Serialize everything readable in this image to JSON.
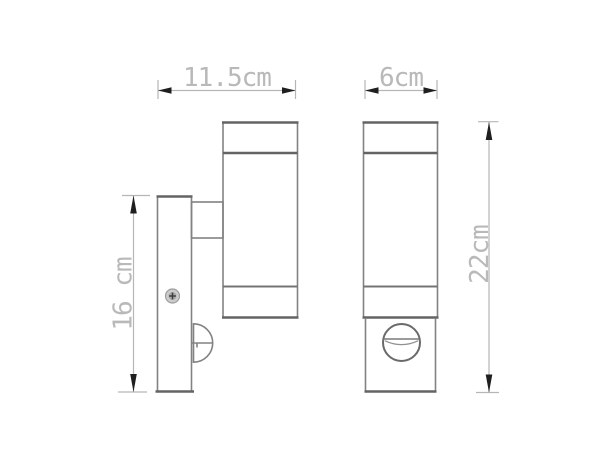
{
  "drawing": {
    "type": "technical-dimension-drawing",
    "unit": "cm",
    "dimensions": [
      {
        "id": "overall-depth-side-view",
        "label": "11.5cm",
        "orientation": "horizontal"
      },
      {
        "id": "body-width-front-view",
        "label": "6cm",
        "orientation": "horizontal"
      },
      {
        "id": "backplate-height",
        "label": "16 cm",
        "orientation": "vertical"
      },
      {
        "id": "overall-height",
        "label": "22cm",
        "orientation": "vertical"
      }
    ],
    "colors": {
      "outline": "#828282",
      "outline_dark": "#646464",
      "dimension_line": "#b6b6b6",
      "dimension_text": "#b9b9b9",
      "arrow": "#1f1f1f",
      "screw_fill": "#cccccc",
      "background": "#ffffff"
    }
  }
}
